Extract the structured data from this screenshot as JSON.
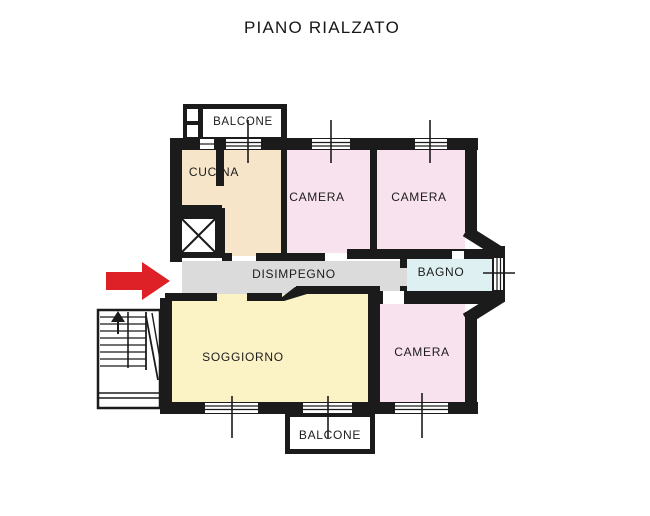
{
  "title": "PIANO RIALZATO",
  "floorplan": {
    "rooms": [
      {
        "id": "balcone-top",
        "label": "BALCONE",
        "color": "#ffffff"
      },
      {
        "id": "cucina",
        "label": "CUCINA",
        "color": "#f7e5ca"
      },
      {
        "id": "camera-nord-ovest",
        "label": "CAMERA",
        "color": "#f8e2ee"
      },
      {
        "id": "camera-nord-est",
        "label": "CAMERA",
        "color": "#f8e2ee"
      },
      {
        "id": "disimpegno",
        "label": "DISIMPEGNO",
        "color": "#dbdbdb"
      },
      {
        "id": "bagno",
        "label": "BAGNO",
        "color": "#def0f2"
      },
      {
        "id": "soggiorno",
        "label": "SOGGIORNO",
        "color": "#fbf3c5"
      },
      {
        "id": "camera-sud-est",
        "label": "CAMERA",
        "color": "#f8e2ee"
      },
      {
        "id": "balcone-bottom",
        "label": "BALCONE",
        "color": "#ffffff"
      }
    ],
    "icons": {
      "entrance_arrow": "red-right-arrow",
      "elevator": "crossed-box",
      "stairs": "up-staircase"
    },
    "colors": {
      "wall": "#1b1b1b",
      "entrance_arrow": "#de2126"
    }
  }
}
